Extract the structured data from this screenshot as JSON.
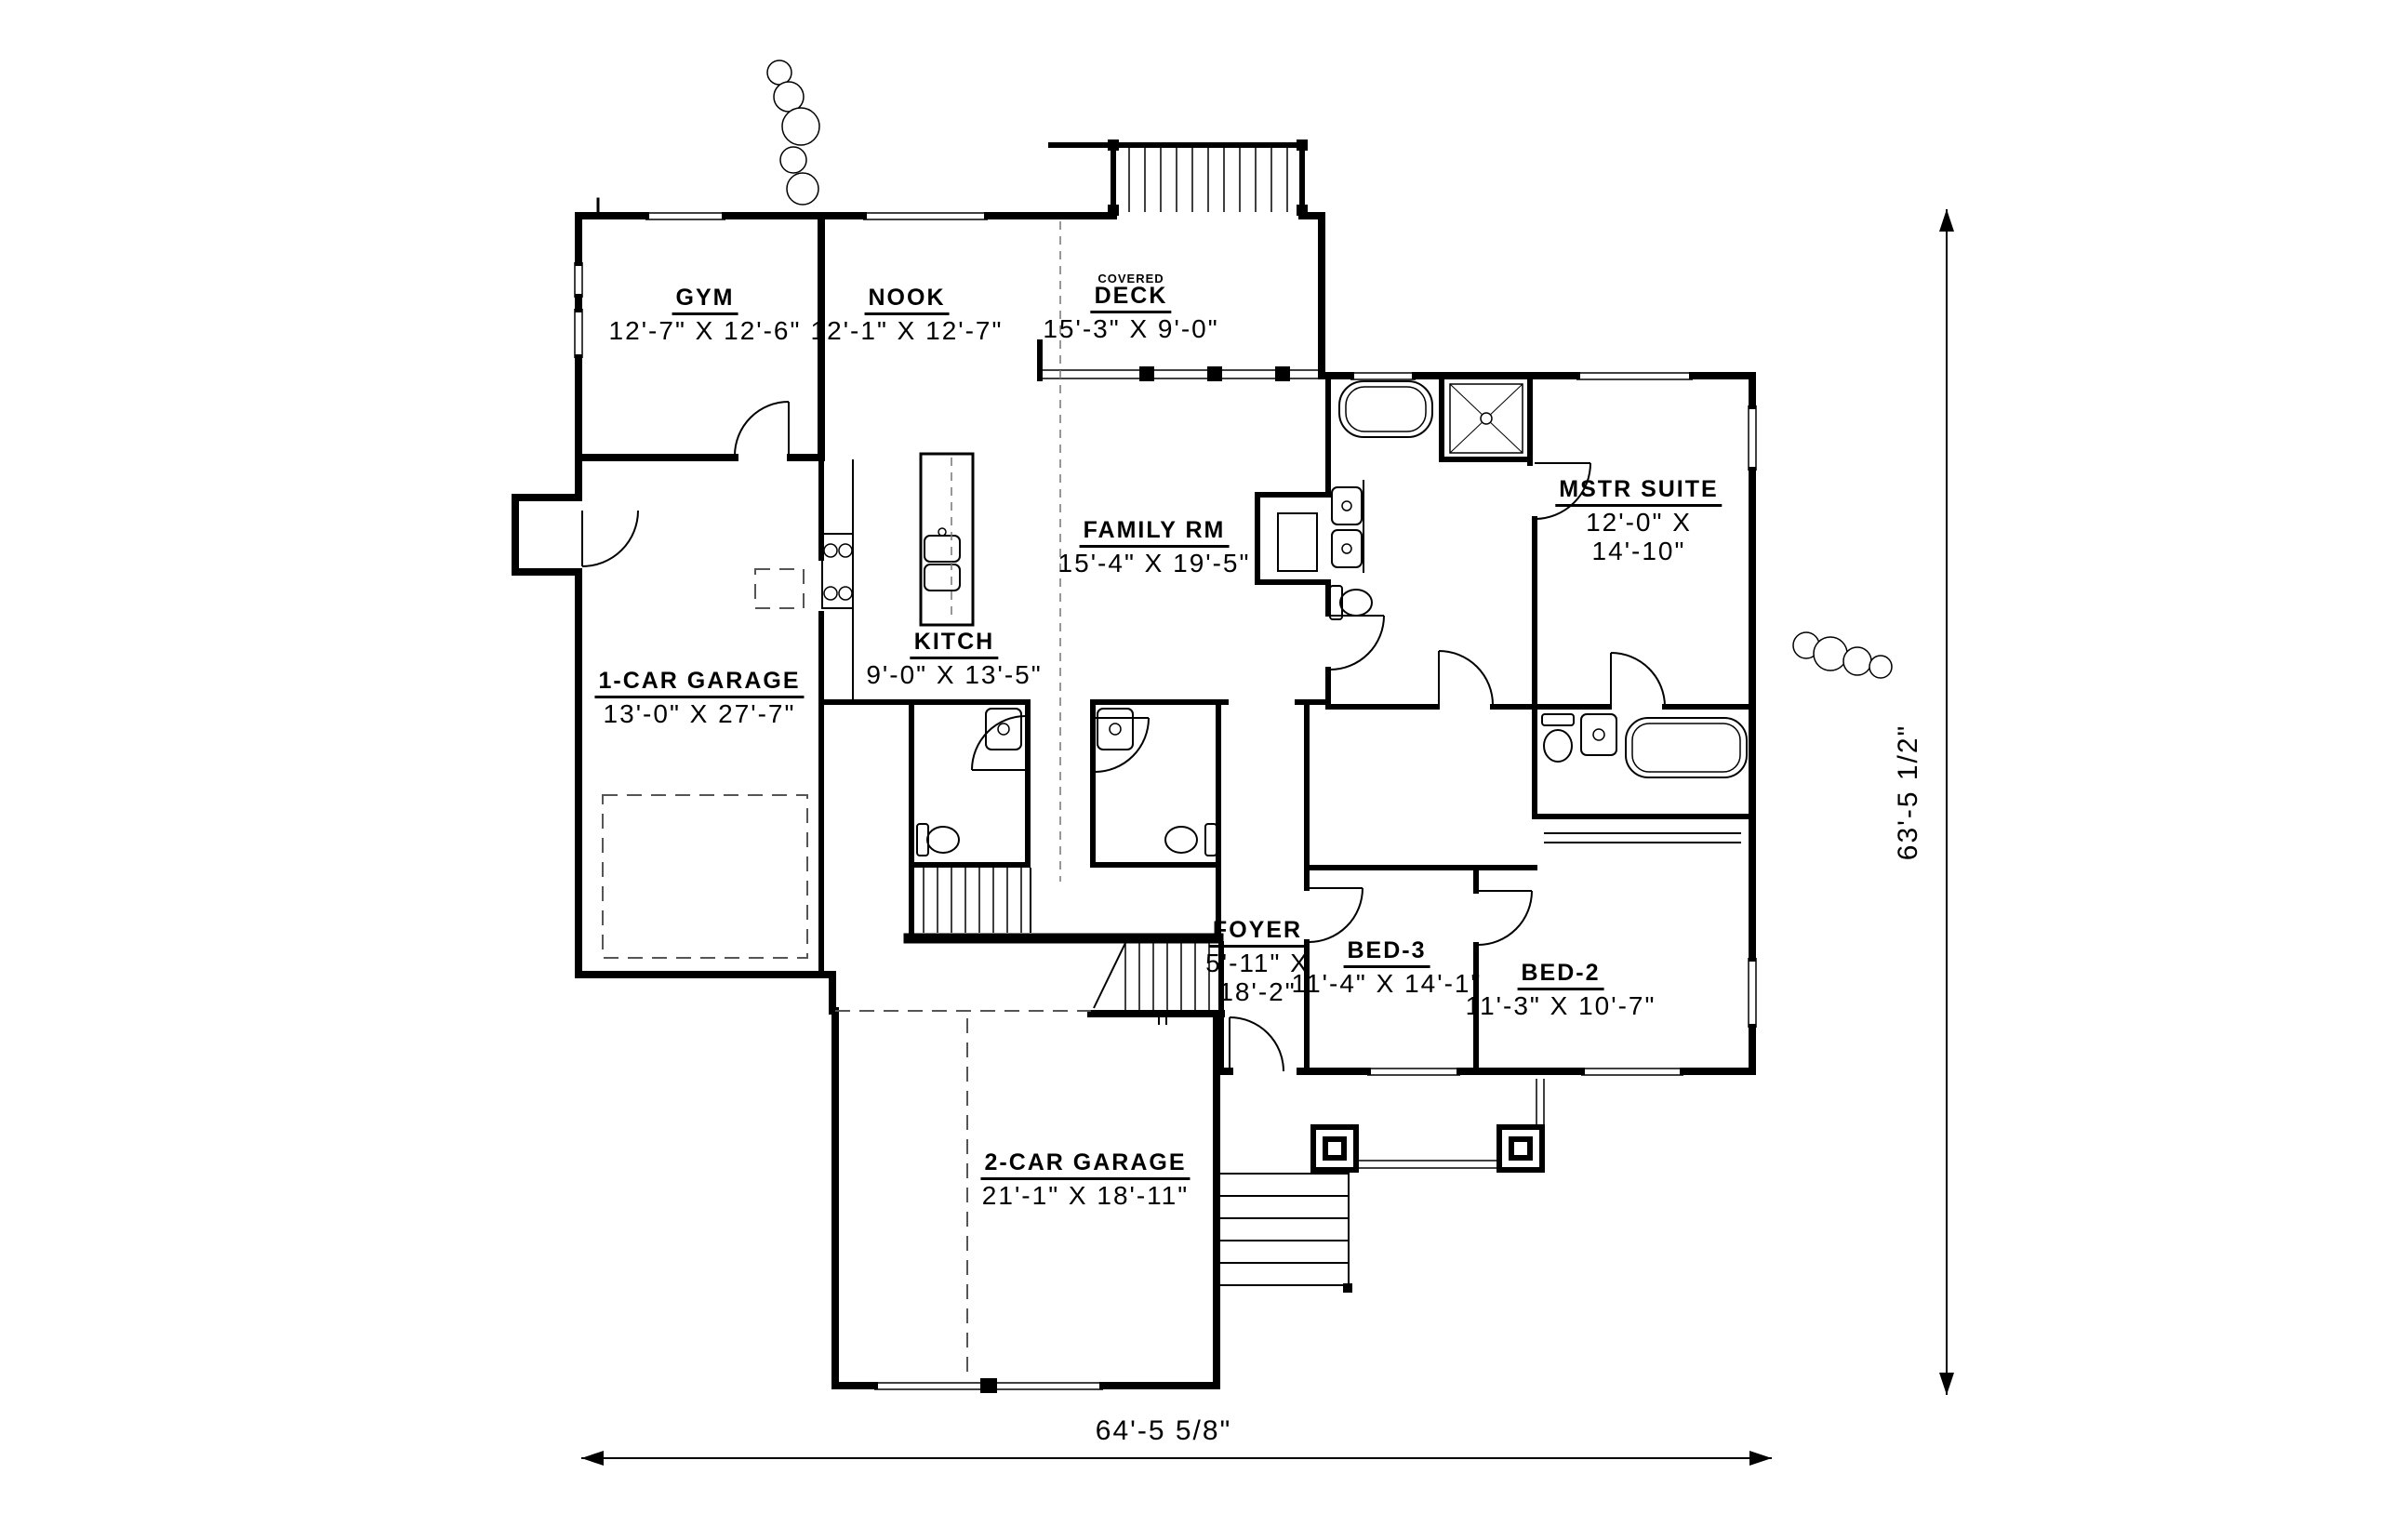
{
  "plan": {
    "type": "architectural-floor-plan",
    "rooms": [
      {
        "id": "gym",
        "name": "GYM",
        "dims": "12'-7\" X 12'-6\""
      },
      {
        "id": "nook",
        "name": "NOOK",
        "dims": "12'-1\" X 12'-7\""
      },
      {
        "id": "covered-deck",
        "name_small": "COVERED",
        "name": "DECK",
        "dims": "15'-3\" X 9'-0\""
      },
      {
        "id": "family-rm",
        "name": "FAMILY RM",
        "dims": "15'-4\" X 19'-5\""
      },
      {
        "id": "kitch",
        "name": "KITCH",
        "dims": "9'-0\" X 13'-5\""
      },
      {
        "id": "mstr-suite",
        "name": "MSTR SUITE",
        "dims_line1": "12'-0\" X",
        "dims_line2": "14'-10\""
      },
      {
        "id": "one-car-garage",
        "name": "1-CAR GARAGE",
        "dims": "13'-0\" X 27'-7\""
      },
      {
        "id": "foyer",
        "name": "FOYER",
        "dims_line1": "5'-11\" X",
        "dims_line2": "18'-2\""
      },
      {
        "id": "bed-3",
        "name": "BED-3",
        "dims": "11'-4\" X 14'-1\""
      },
      {
        "id": "bed-2",
        "name": "BED-2",
        "dims": "11'-3\" X 10'-7\""
      },
      {
        "id": "two-car-garage",
        "name": "2-CAR GARAGE",
        "dims": "21'-1\" X 18'-11\""
      }
    ],
    "dimensions": {
      "overall_width": "64'-5 5/8\"",
      "overall_height": "63'-5 1/2\""
    },
    "colors": {
      "ink": "#000000",
      "paper": "#ffffff",
      "dashed": "#555555"
    }
  }
}
